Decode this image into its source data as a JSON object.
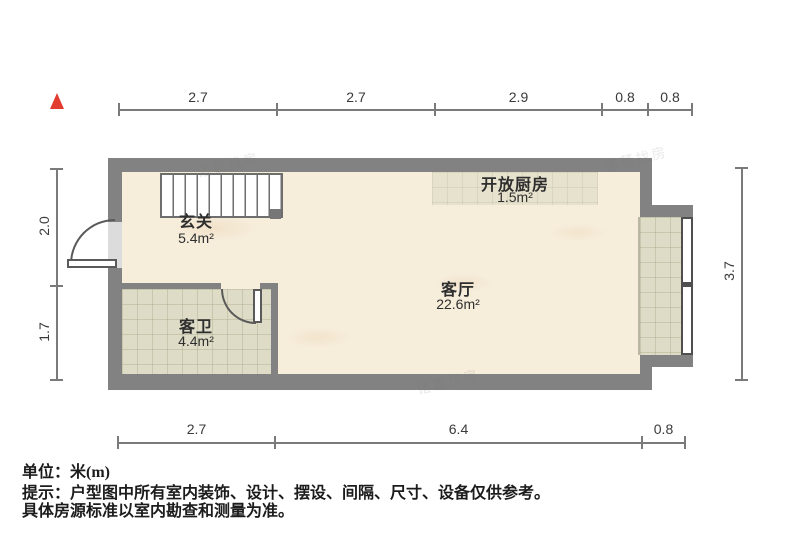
{
  "compass": {
    "icon": "north-triangle",
    "color": "#e23b30"
  },
  "rooms": [
    {
      "id": "entry",
      "name": "玄关",
      "area": "5.4m²"
    },
    {
      "id": "bathroom",
      "name": "客卫",
      "area": "4.4m²"
    },
    {
      "id": "living",
      "name": "客厅",
      "area": "22.6m²"
    },
    {
      "id": "kitchen",
      "name": "开放厨房",
      "area": "1.5m²"
    }
  ],
  "dimensions": {
    "unit": "m",
    "top": [
      "2.7",
      "2.7",
      "2.9",
      "0.8",
      "0.8"
    ],
    "bottom": [
      "2.7",
      "6.4",
      "0.8"
    ],
    "left": [
      "2.0",
      "1.7"
    ],
    "right": [
      "3.7"
    ]
  },
  "notes": {
    "unit_line": "单位：米(m)",
    "tip_line1": "提示：户型图中所有室内装饰、设计、摆设、间隔、尺寸、设备仅供参考。",
    "tip_line2": "具体房源标准以室内勘查和测量为准。"
  },
  "watermark": {
    "text": "诸葛找房"
  },
  "colors": {
    "wall": "#828282",
    "floor": "#f6eddb",
    "tile": "#dedcc6",
    "dimension": "#7a7a7a",
    "north": "#e23b30"
  }
}
